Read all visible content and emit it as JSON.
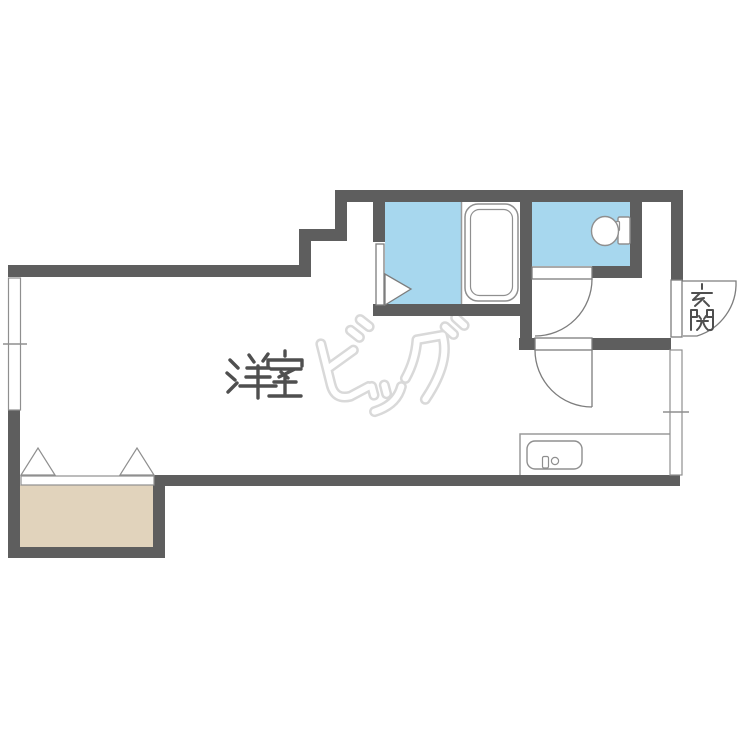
{
  "document": {
    "type": "floor-plan"
  },
  "labels": {
    "main_room": "洋室",
    "entrance": "玄関"
  },
  "watermark": {
    "text": "ビッグ"
  },
  "colors": {
    "wall": "#5e5e5e",
    "water_area": "#a7d7ee",
    "closet_floor": "#e1d3bc",
    "fixture_outline": "#8f8f8f",
    "door_line": "#7d7d7d",
    "label_text": "#4f4f4f",
    "watermark": "#d9d9d9"
  },
  "fixtures": {
    "bathtub": "bathtub-icon",
    "toilet": "toilet-icon",
    "kitchen_sink": "kitchen-sink-icon",
    "closet_doors": "folding-door-triangles",
    "washroom_door": "door-triangle",
    "hinged_doors": "door-swing-arc",
    "windows": "window-with-tick"
  }
}
